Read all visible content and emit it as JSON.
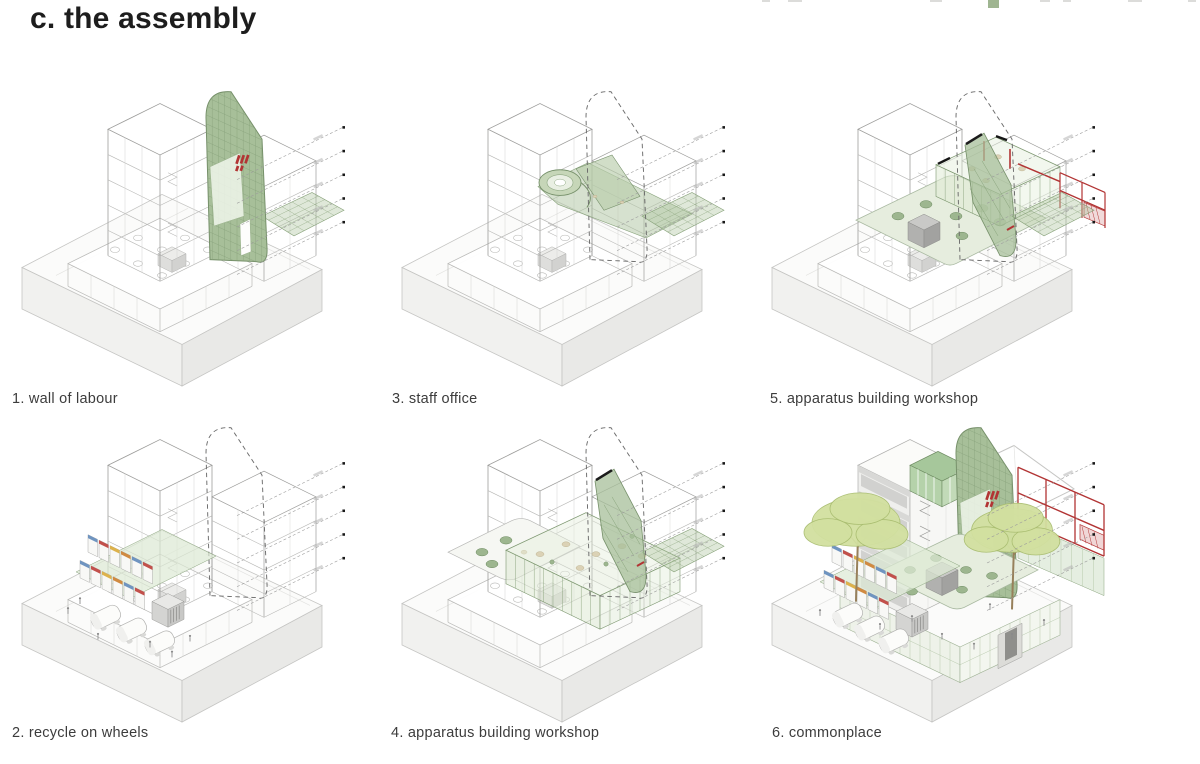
{
  "page": {
    "title": "c. the assembly",
    "leaders_per_panel": 5
  },
  "colors": {
    "tab_green": "#9fb591",
    "wire": "#b9b9b7",
    "wire_dark": "#9d9d9b",
    "wire_light": "#d4d4d2",
    "plinth_top": "#fbfbfa",
    "plinth_left": "#f1f1ef",
    "plinth_right": "#e9e9e7",
    "plinth_stroke": "#c5c5c3",
    "green_wall": "#a7bf99",
    "green_wall_stroke": "#76906a",
    "green_grid": "#87a17a",
    "green_glass": "#dfe9d6",
    "green_blob": "#9db68f",
    "green_blob_stroke": "#6d8a61",
    "terrace_green": "#e6edde",
    "red": "#b23434",
    "beige": "#dbd2b6",
    "beige_stroke": "#b5a986",
    "stall_colors": [
      "#6f94c0",
      "#c2504b",
      "#ddb24c",
      "#d08a41"
    ],
    "tree_fill": "#d2e0a0",
    "tree_stroke": "#a9bd70",
    "trunk": "#97805b"
  },
  "panels": [
    {
      "id": "1",
      "caption": "1. wall of labour",
      "features": [
        "plinth",
        "podium",
        "wireTower",
        "wireAnnex",
        "checkerDeck",
        "wallSolid",
        "leaders"
      ]
    },
    {
      "id": "3",
      "caption": "3. staff office",
      "features": [
        "plinth",
        "podium",
        "wireTower",
        "wireAnnex",
        "spiral",
        "checkerDeck",
        "wallDashed",
        "leaders"
      ]
    },
    {
      "id": "5",
      "caption": "5. apparatus building workshop",
      "features": [
        "plinth",
        "podium",
        "wireTower",
        "wireAnnex",
        "roofTerrace",
        "workshopL2",
        "redFrameSmall",
        "wallDashed",
        "wallBlade",
        "checkerDeck",
        "leaders"
      ]
    },
    {
      "id": "2",
      "caption": "2. recycle on wheels",
      "features": [
        "plinth",
        "podium",
        "wireTower",
        "wireAnnex",
        "wallDashed",
        "stalls2",
        "vans2",
        "people2",
        "leaders"
      ]
    },
    {
      "id": "4",
      "caption": "4. apparatus building workshop",
      "features": [
        "plinth",
        "podium",
        "wireTower",
        "wireAnnex",
        "terraceL",
        "workshopL1",
        "checkerDeck",
        "wallDashed",
        "wallBlade",
        "leaders"
      ]
    },
    {
      "id": "6",
      "caption": "6. commonplace",
      "features": [
        "plinth",
        "towerSolid",
        "greenBoxTop",
        "whiteRoof",
        "wallSolid",
        "redFrame",
        "facadeGlazed",
        "stalls6",
        "vans6",
        "trees",
        "people6",
        "leaders"
      ]
    }
  ]
}
